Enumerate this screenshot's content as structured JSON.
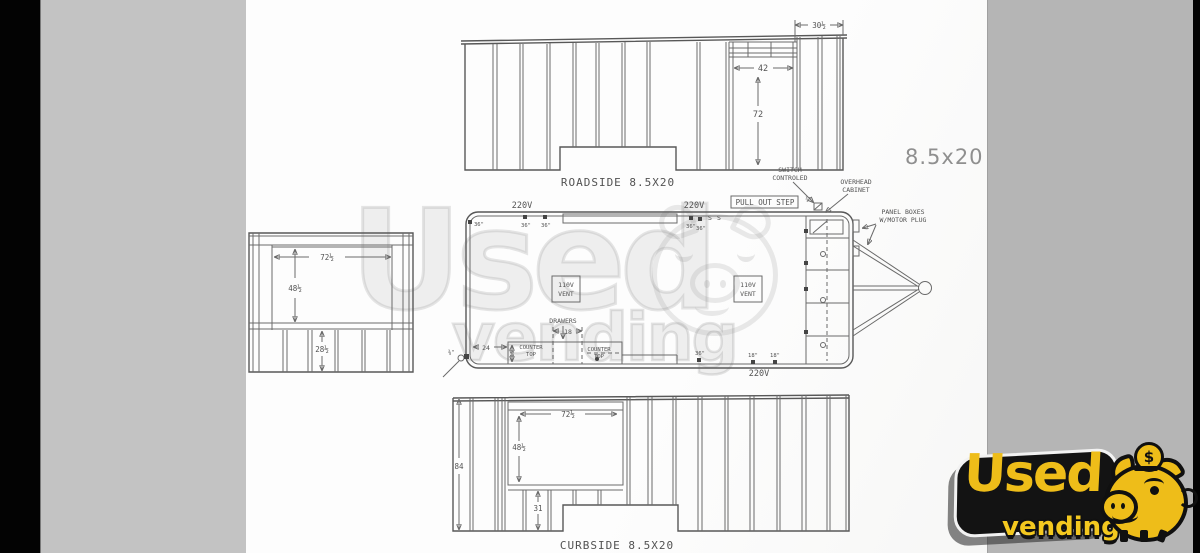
{
  "frame": {
    "size_label": "8.5x20"
  },
  "roadside": {
    "title": "ROADSIDE 8.5X20",
    "dim_top": "30½",
    "dim_window_w": "42",
    "dim_window_h": "72"
  },
  "plan": {
    "power_top_left": "220V",
    "power_top_right": "220V",
    "power_bottom": "220V",
    "pull_out_step": "PULL OUT STEP",
    "switch_l1": "SWITCH",
    "switch_l2": "CONTROLED",
    "switch_box": "¾\"",
    "overhead_l1": "OVERHEAD",
    "overhead_l2": "CABINET",
    "panel_l1": "PANEL BOXES",
    "panel_l2": "W/MOTOR PLUG",
    "vent_l1": "110V",
    "vent_l2": "VENT",
    "drawers": "DRAWERS",
    "dim_18": "18",
    "dim_24": "24",
    "dim_15": "15",
    "counter_l1": "COUNTER",
    "counter_l2": "TOP",
    "sw": "S",
    "outlets": {
      "a": "36\"",
      "b": "36\"",
      "c": "36\"",
      "d": "36\"",
      "e": "36\"",
      "f": "18\"",
      "g": "18\"",
      "h": "36\"",
      "i": "⅜\""
    }
  },
  "front_view": {
    "dim_w": "72½",
    "dim_h": "48½",
    "dim_lower": "28½"
  },
  "curbside": {
    "title": "CURBSIDE 8.5X20",
    "dim_height": "84",
    "dim_w": "72½",
    "dim_h": "48½",
    "dim_lower": "31"
  },
  "watermark": {
    "word1": "Used",
    "word2": "vending"
  },
  "logo": {
    "word1": "Used",
    "word2": "vending",
    "coin": "$",
    "accent_color": "#eebd19"
  }
}
